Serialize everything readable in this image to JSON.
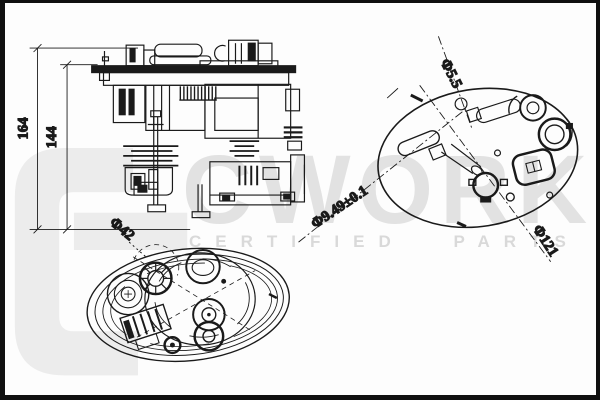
{
  "page": {
    "background": "#fdfdfd",
    "frame_color": "#101010",
    "ink_color": "#1a1a1a"
  },
  "labels": {
    "height_total": "164",
    "height_inner": "144",
    "bottom_diameter": "Φ42",
    "hole_diameter": "Φ5.5",
    "port_diameter": "Φ9.49±0.1",
    "flange_diameter": "Φ121"
  },
  "watermark": {
    "brand": "CWORKS",
    "tagline": "CERTIFIED PARTS",
    "brand_color": "#e2e2e2",
    "tagline_color": "#d9d9d9",
    "logo_color": "#ececec"
  }
}
